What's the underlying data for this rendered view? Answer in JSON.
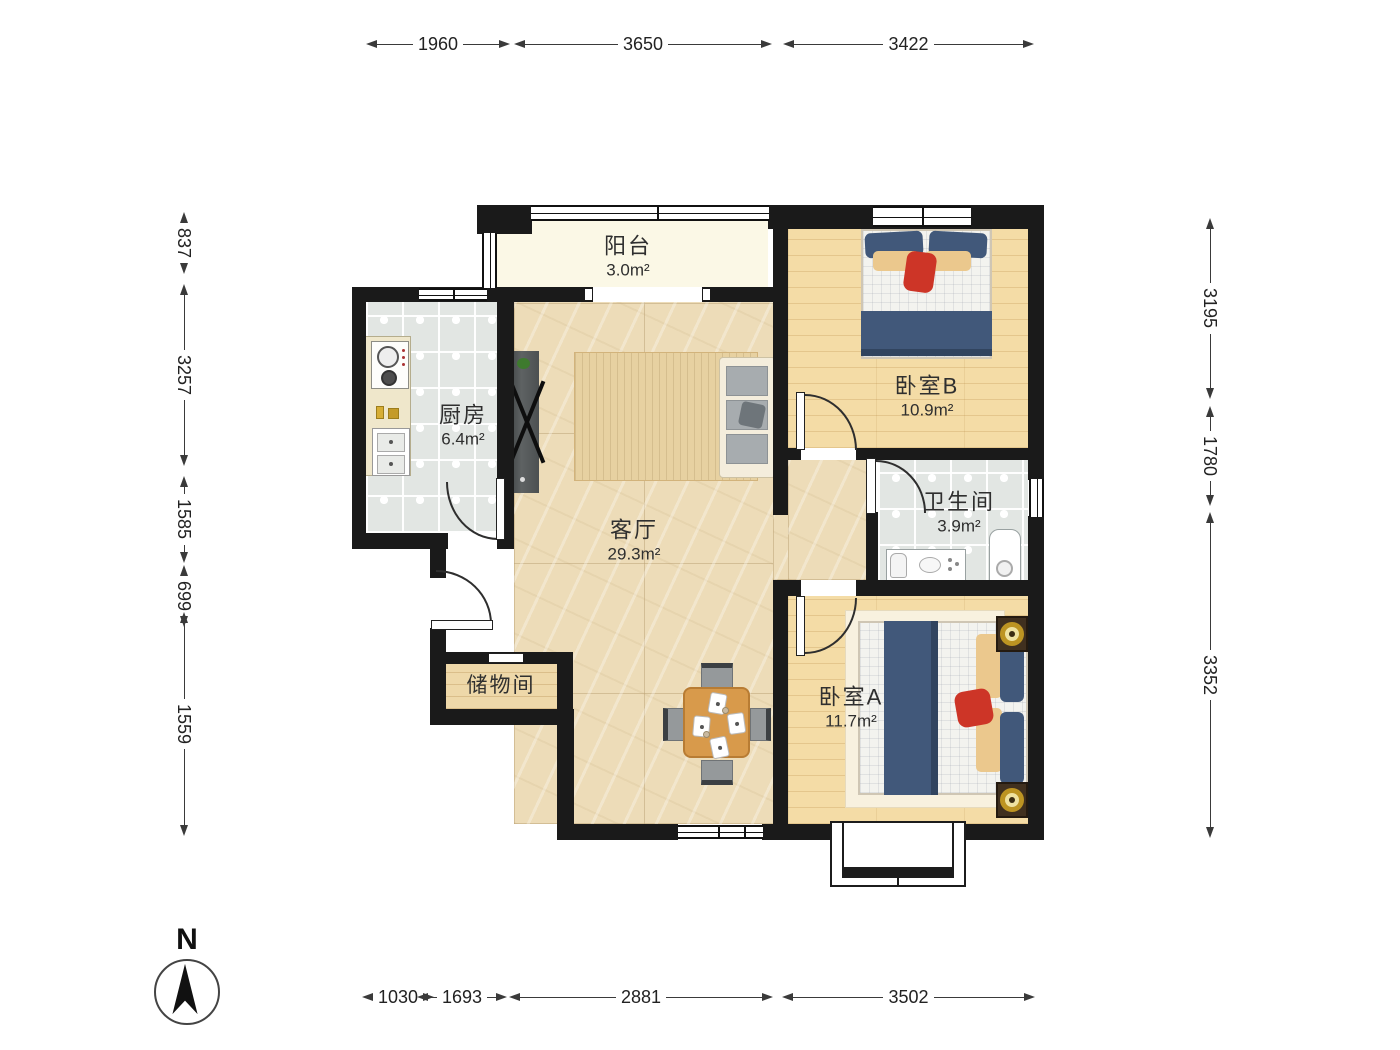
{
  "compass": {
    "north_label": "N"
  },
  "rooms": {
    "balcony": {
      "name": "阳台",
      "area": "3.0m²"
    },
    "kitchen": {
      "name": "厨房",
      "area": "6.4m²"
    },
    "living": {
      "name": "客厅",
      "area": "29.3m²"
    },
    "bedroom_b": {
      "name": "卧室B",
      "area": "10.9m²"
    },
    "bathroom": {
      "name": "卫生间",
      "area": "3.9m²"
    },
    "bedroom_a": {
      "name": "卧室A",
      "area": "11.7m²"
    },
    "storage": {
      "name": "储物间"
    }
  },
  "dimensions": {
    "top": [
      {
        "value": "1960"
      },
      {
        "value": "3650"
      },
      {
        "value": "3422"
      }
    ],
    "bottom": [
      {
        "value": "1030"
      },
      {
        "value": "1693"
      },
      {
        "value": "2881"
      },
      {
        "value": "3502"
      }
    ],
    "left": [
      {
        "value": "837"
      },
      {
        "value": "3257"
      },
      {
        "value": "1585"
      },
      {
        "value": "699"
      },
      {
        "value": "1559"
      }
    ],
    "right": [
      {
        "value": "3195"
      },
      {
        "value": "1780"
      },
      {
        "value": "3352"
      }
    ]
  },
  "colors": {
    "wall": "#1a1a1a",
    "marble_floor": "#eddcb8",
    "wood_floor": "#f4dca6",
    "tile_floor": "#e2e6e3",
    "balcony_floor": "#fbf8e6",
    "blanket_blue": "#41587a",
    "pillow_tan": "#ebc88d",
    "accent_red": "#cd3527",
    "table_wood": "#d89a4b",
    "dim_text": "#222222"
  }
}
